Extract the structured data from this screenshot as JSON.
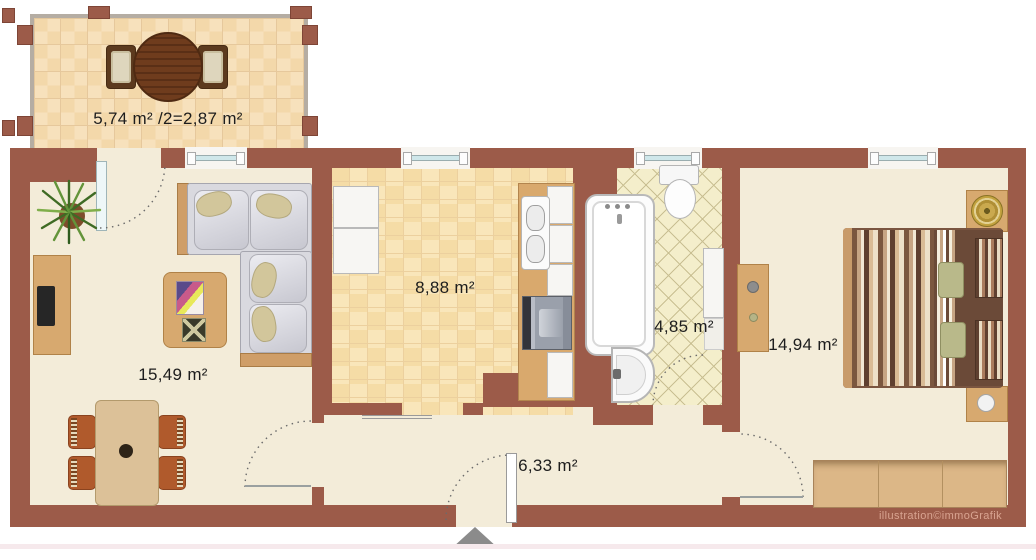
{
  "rooms": {
    "balcony": {
      "area_label": "5,74 m² /2=2,87 m²"
    },
    "living_room": {
      "area_label": "15,49 m²"
    },
    "kitchen": {
      "area_label": "8,88 m²"
    },
    "bathroom": {
      "area_label": "4,85 m²"
    },
    "bedroom": {
      "area_label": "14,94 m²"
    },
    "hallway": {
      "area_label": "6,33 m²"
    }
  },
  "watermark": "illustration©immoGrafik",
  "palette": {
    "wall": "#9c5b49",
    "floor_cream": "#f3ecd9",
    "balcony_tile": "#f6dfb8",
    "kitchen_tile": "#f8e3b2",
    "bathroom_tile": "#f4eecb",
    "wood": "#d7a96f",
    "window_glass": "#cfe7ea",
    "entrance_arrow": "#8b8b8b",
    "watermark_color": "#d9a491"
  },
  "icons": {
    "entrance_arrow": "triangle-up",
    "potted_plant": "plant-top-view",
    "door_swing": "dotted-quarter-arc"
  }
}
